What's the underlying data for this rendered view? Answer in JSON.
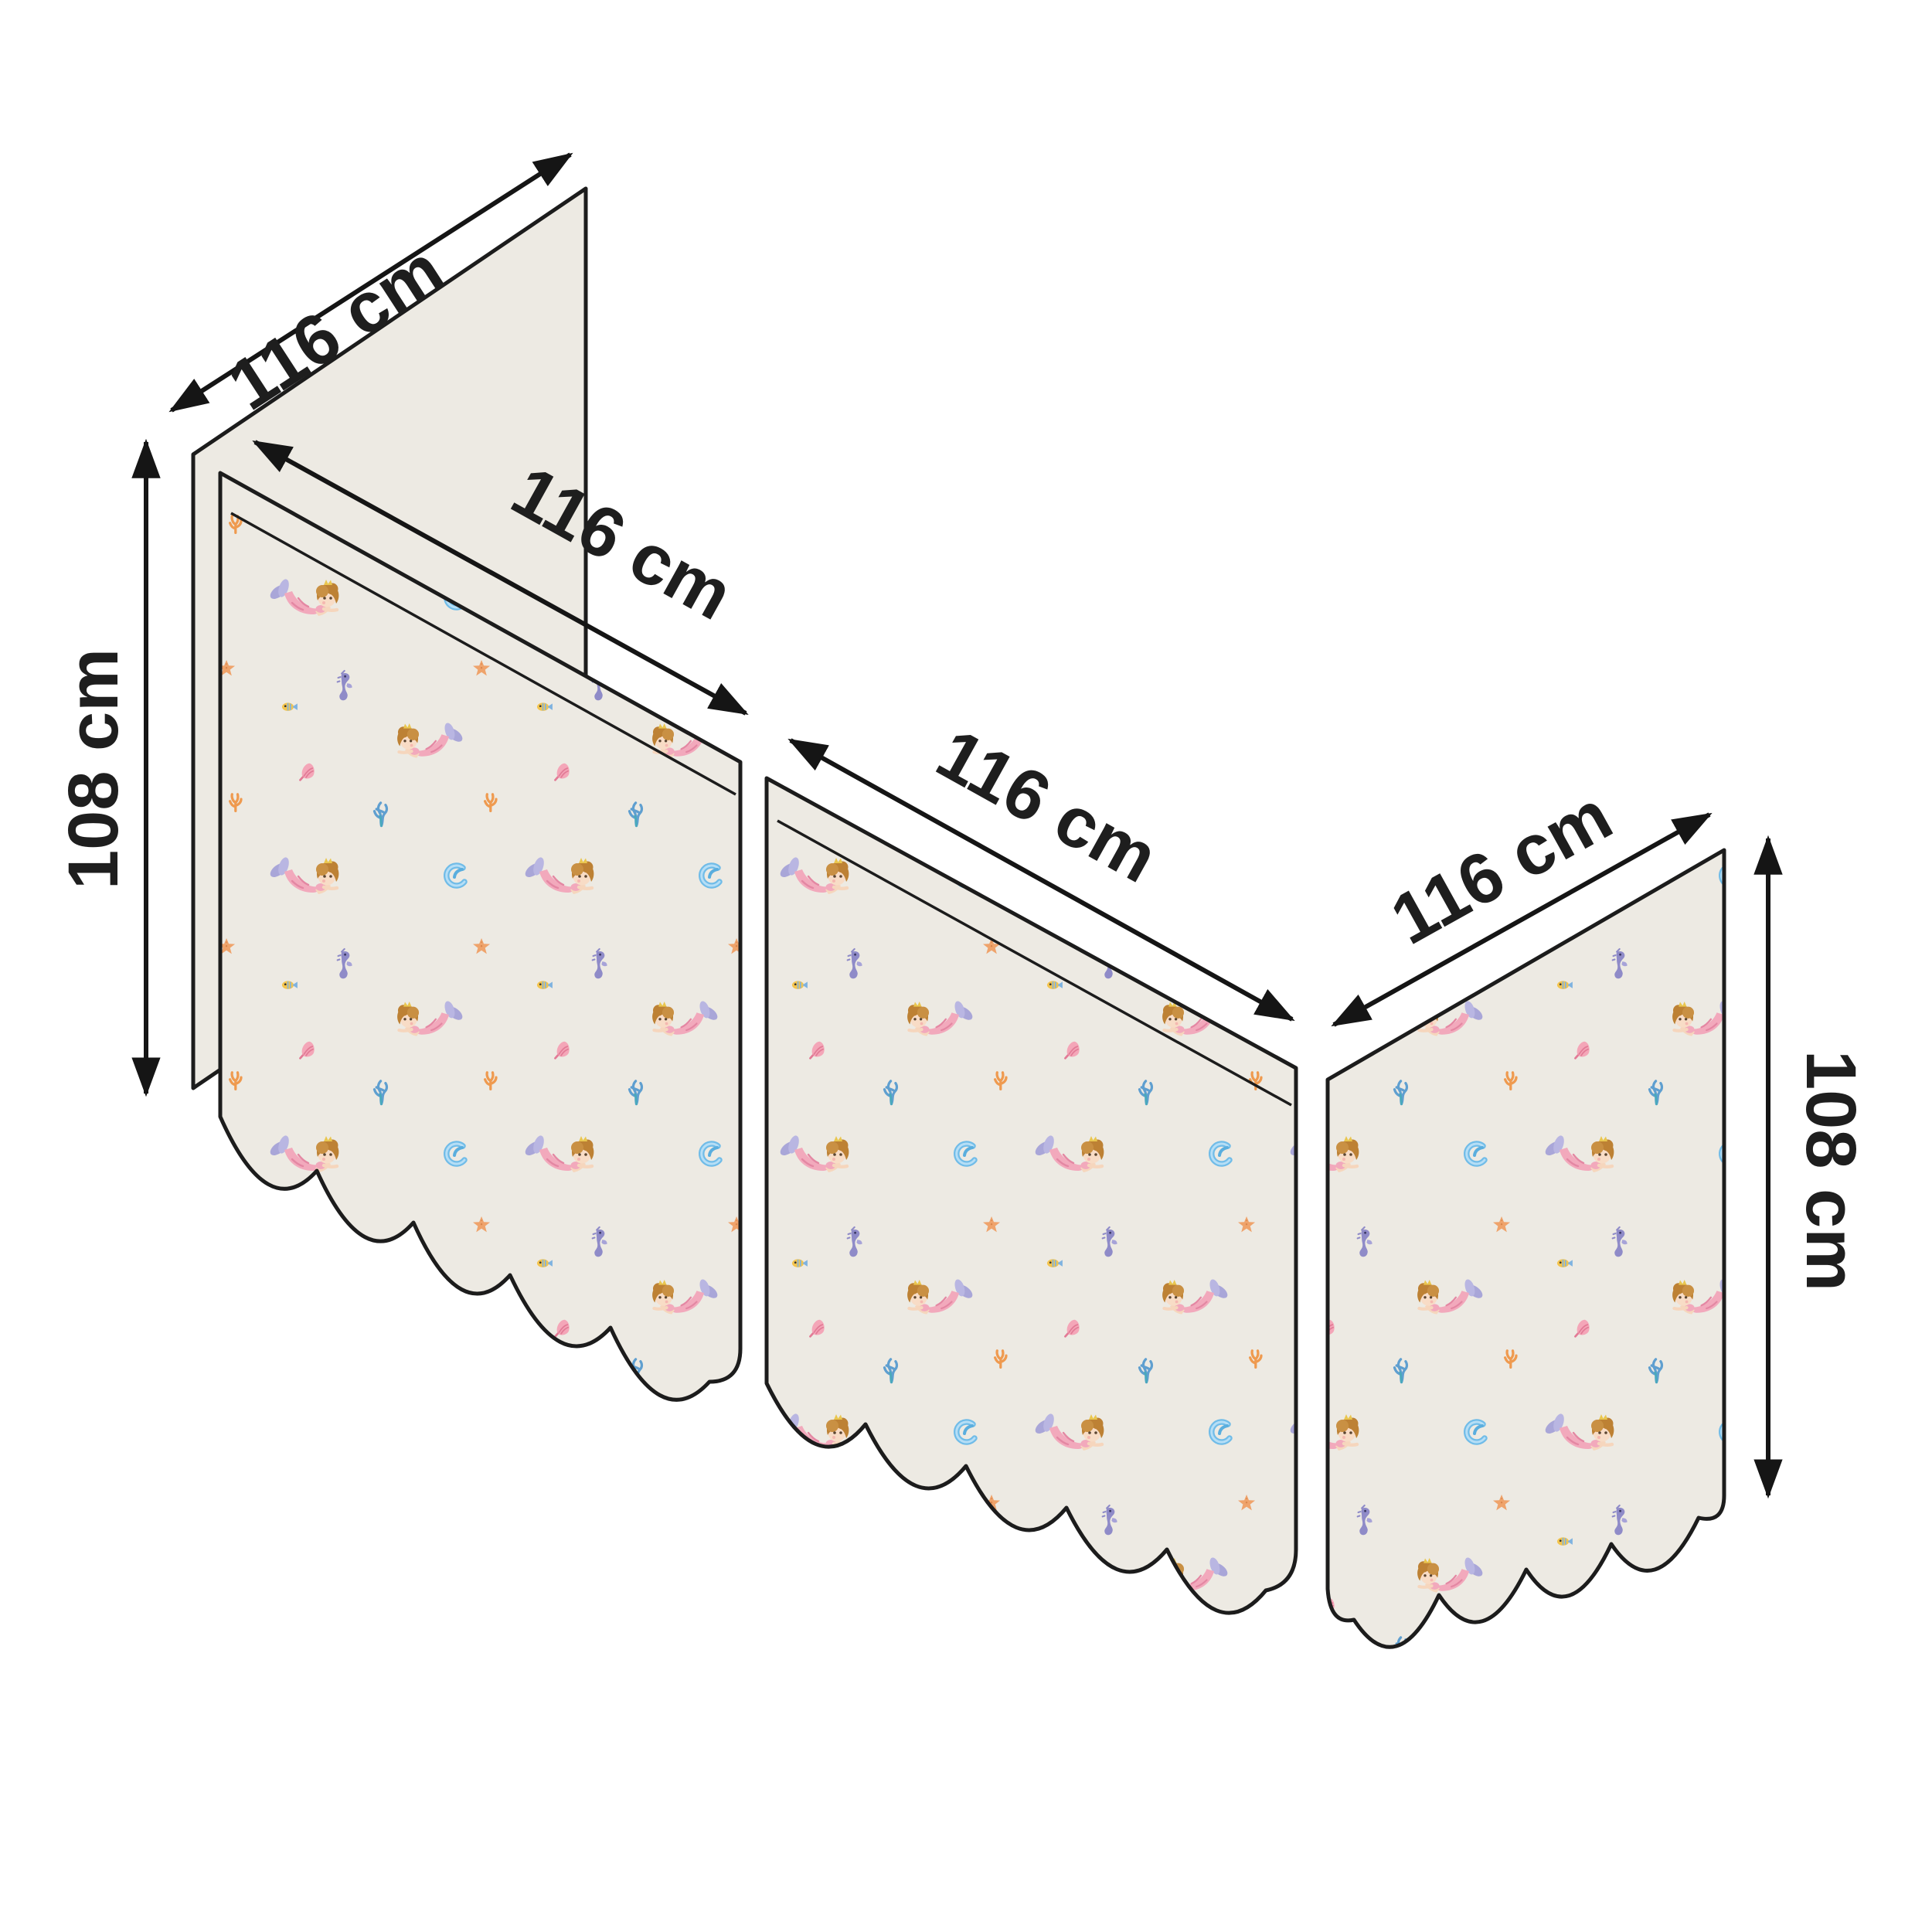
{
  "diagram": {
    "kind": "curtain-set-dimension-diagram",
    "unit": "cm",
    "labels": {
      "back_width": "116 cm",
      "panel1_width": "116 cm",
      "panel2_width": "116 cm",
      "panel3_width": "116 cm",
      "left_height": "108 cm",
      "right_height": "108 cm"
    },
    "measurements": {
      "panel_width_cm": 116,
      "panel_height_cm": 108
    },
    "panels": [
      {
        "id": "back-panel",
        "fabric": "plain"
      },
      {
        "id": "front-panel-1",
        "fabric": "mermaid-pattern",
        "hem": "scalloped"
      },
      {
        "id": "front-panel-2",
        "fabric": "mermaid-pattern",
        "hem": "scalloped"
      },
      {
        "id": "side-panel-3",
        "fabric": "mermaid-pattern",
        "hem": "scalloped"
      }
    ],
    "pattern_motifs": [
      "mermaid",
      "seahorse",
      "wave-curl",
      "starfish",
      "coral-sprig",
      "seaweed",
      "conch-shell",
      "fish"
    ],
    "colors": {
      "page_background": "#ffffff",
      "fabric_background": "#edeae3",
      "outline": "#1c1c1c",
      "dimension_text": "#1e1e1e",
      "mermaid_hair": "#bd8134",
      "mermaid_skin": "#f8dcc6",
      "mermaid_tail_pink": "#f2a9bc",
      "mermaid_fin_lavender": "#a9a6d8",
      "seahorse_purple": "#8f8bc8",
      "wave_blue": "#70bce8",
      "starfish_orange": "#efa36b",
      "coral_orange": "#ef9a4f",
      "seaweed_blue": "#5f9fd0",
      "shell_pink": "#f4a6b8",
      "fish_yellow": "#f3c44e"
    }
  }
}
